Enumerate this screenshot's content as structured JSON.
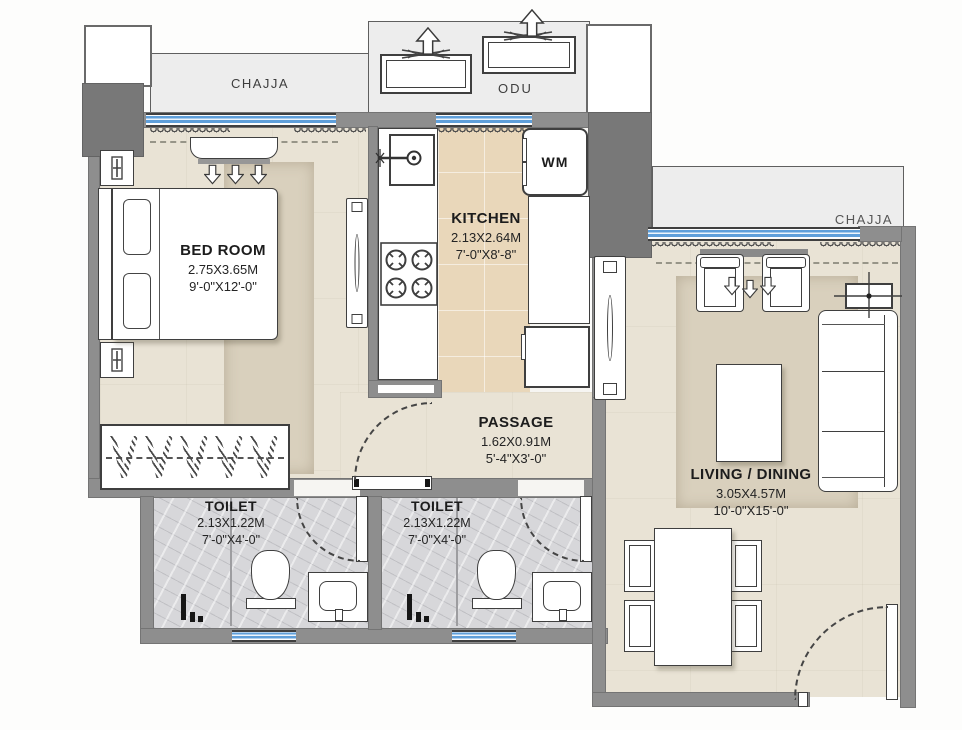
{
  "meta": {
    "type": "apartment-floor-plan"
  },
  "colors": {
    "wall": "#8e8e8e",
    "wall_dark": "#787878",
    "floor": "#e9e3d5",
    "kitchen_floor": "#e9d7ba",
    "toilet_floor": "#d7d7da",
    "rug": "#d9d0bd",
    "chajja_band": "#ededed",
    "window_glass": "#5f9fda",
    "fixture": "#ffffff",
    "line": "#3f3f3f",
    "text": "#1c1c1c"
  },
  "rooms": {
    "bedroom": {
      "name": "BED ROOM",
      "metric": "2.75X3.65M",
      "imperial": "9'-0\"X12'-0\""
    },
    "kitchen": {
      "name": "KITCHEN",
      "metric": "2.13X2.64M",
      "imperial": "7'-0\"X8'-8\""
    },
    "passage": {
      "name": "PASSAGE",
      "metric": "1.62X0.91M",
      "imperial": "5'-4\"X3'-0\""
    },
    "toilet1": {
      "name": "TOILET",
      "metric": "2.13X1.22M",
      "imperial": "7'-0\"X4'-0\""
    },
    "toilet2": {
      "name": "TOILET",
      "metric": "2.13X1.22M",
      "imperial": "7'-0\"X4'-0\""
    },
    "living": {
      "name": "LIVING / DINING",
      "metric": "3.05X4.57M",
      "imperial": "10'-0\"X15'-0\""
    }
  },
  "annotations": {
    "chajja_left": "CHAJJA",
    "chajja_right": "CHAJJA",
    "odu": "ODU",
    "washing_machine": "WM"
  }
}
